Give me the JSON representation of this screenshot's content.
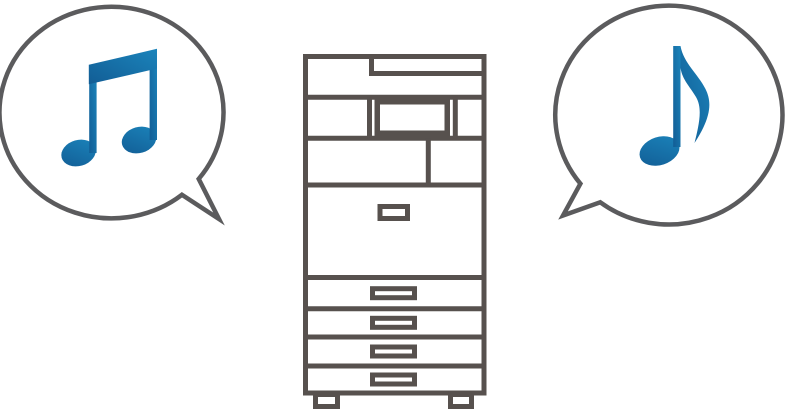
{
  "illustration": {
    "description": "Multifunction printer emitting operation sounds, shown as musical notes inside speech bubbles",
    "left_bubble": {
      "name": "speech-bubble-left",
      "icon": "beamed-eighth-notes-icon",
      "tail_direction": "bottom-right"
    },
    "printer": {
      "name": "multifunction-printer-icon",
      "visible_parts": [
        "document-feeder-top",
        "control-panel-display",
        "front-door",
        "door-handle",
        "paper-tray-1",
        "paper-tray-2",
        "paper-tray-3",
        "paper-tray-4",
        "foot-left",
        "foot-right"
      ]
    },
    "right_bubble": {
      "name": "speech-bubble-right",
      "icon": "eighth-note-icon",
      "tail_direction": "bottom-left"
    }
  },
  "colors": {
    "background": "#ffffff",
    "fill": "#ffffff",
    "bubble_outline": "#5b5b5d",
    "printer_outline": "#57514e",
    "note_blue_dark": "#125d95",
    "note_blue_light": "#1b84bb"
  }
}
